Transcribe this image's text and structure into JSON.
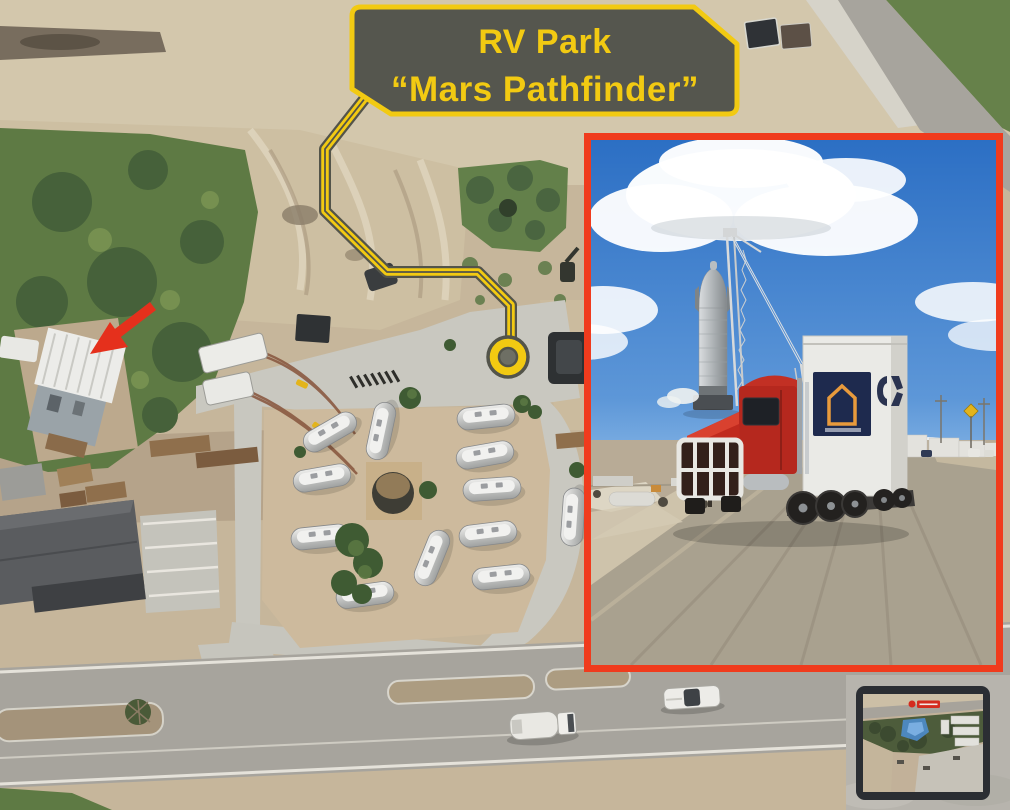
{
  "callout": {
    "line1": "RV Park",
    "line2": "“Mars Pathfinder”"
  },
  "colors": {
    "accent_yellow": "#F2CA12",
    "callout_bg": "#55564E",
    "alert_red": "#E5301C",
    "inset_border": "#F03B1D",
    "marker_center": "#6E6F64",
    "sand": "#C6B69B",
    "vegetation_green": "#5E7A44",
    "concrete": "#C9C8C0",
    "asphalt": "#A7A49D",
    "inset_sky_blue": "#2C6FC4"
  }
}
